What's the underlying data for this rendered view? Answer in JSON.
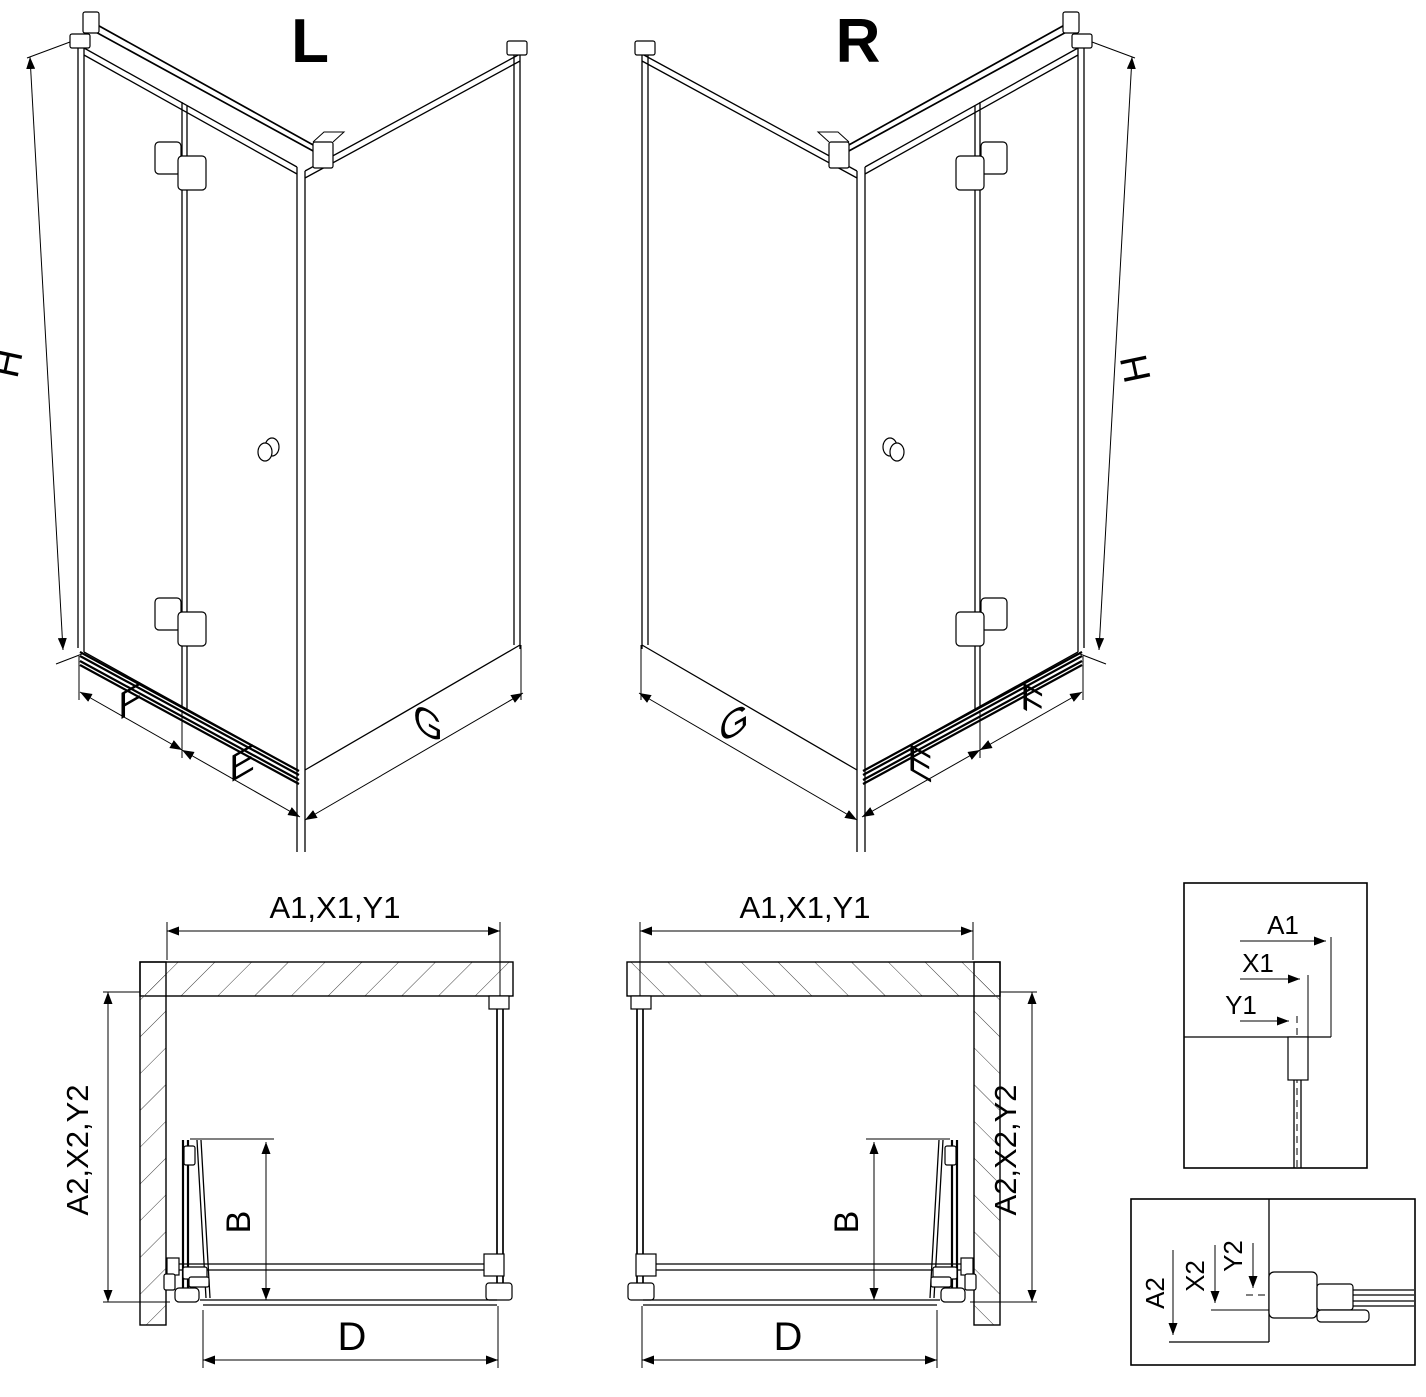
{
  "colors": {
    "line": "#000000",
    "background": "#ffffff",
    "hatch": "#404040"
  },
  "iso": {
    "left_label": "L",
    "right_label": "R",
    "height": "H",
    "door_leaf_width": "F",
    "door_segment_width": "E",
    "side_panel_width": "G"
  },
  "plan": {
    "top_width": "A1,X1,Y1",
    "side_depth": "A2,X2,Y2",
    "fold_depth": "B",
    "entry_width": "D"
  },
  "detail_top": {
    "a1": "A1",
    "x1": "X1",
    "y1": "Y1"
  },
  "detail_bottom": {
    "a2": "A2",
    "x2": "X2",
    "y2": "Y2"
  }
}
